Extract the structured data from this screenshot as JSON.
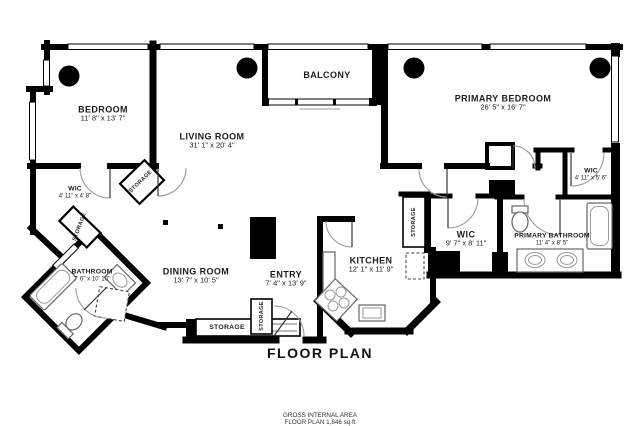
{
  "plan": {
    "title": "FLOOR PLAN",
    "footer_line1": "GROSS INTERNAL AREA",
    "footer_line2": "FLOOR PLAN 1,846 sq ft"
  },
  "rooms": {
    "bedroom": {
      "name": "BEDROOM",
      "dims": "11' 8\" x 13' 7\""
    },
    "living_room": {
      "name": "LIVING ROOM",
      "dims": "31' 1\" x 20' 4\""
    },
    "balcony": {
      "name": "BALCONY",
      "dims": ""
    },
    "primary_bedroom": {
      "name": "PRIMARY BEDROOM",
      "dims": "26' 5\" x 16' 7\""
    },
    "wic_left": {
      "name": "WIC",
      "dims": "4' 11\" x 4' 8\""
    },
    "bathroom": {
      "name": "BATHROOM",
      "dims": "7' 6\" x 10' 10\""
    },
    "dining_room": {
      "name": "DINING ROOM",
      "dims": "13' 7\" x 10' 5\""
    },
    "entry": {
      "name": "ENTRY",
      "dims": "7' 4\" x 13' 9\""
    },
    "kitchen": {
      "name": "KITCHEN",
      "dims": "12' 1\" x 11' 9\""
    },
    "wic_middle": {
      "name": "WIC",
      "dims": "9' 7\" x 8' 11\""
    },
    "primary_bathroom": {
      "name": "PRIMARY BATHROOM",
      "dims": "11' 4\" x 8' 5\""
    },
    "wic_right": {
      "name": "WIC",
      "dims": "4' 11\" x 5' 6\""
    },
    "storage": {
      "name": "STORAGE"
    }
  },
  "colors": {
    "wall": "#000000",
    "bg": "#ffffff",
    "fixture": "#666666",
    "door_arc": "#9a9a9a"
  }
}
